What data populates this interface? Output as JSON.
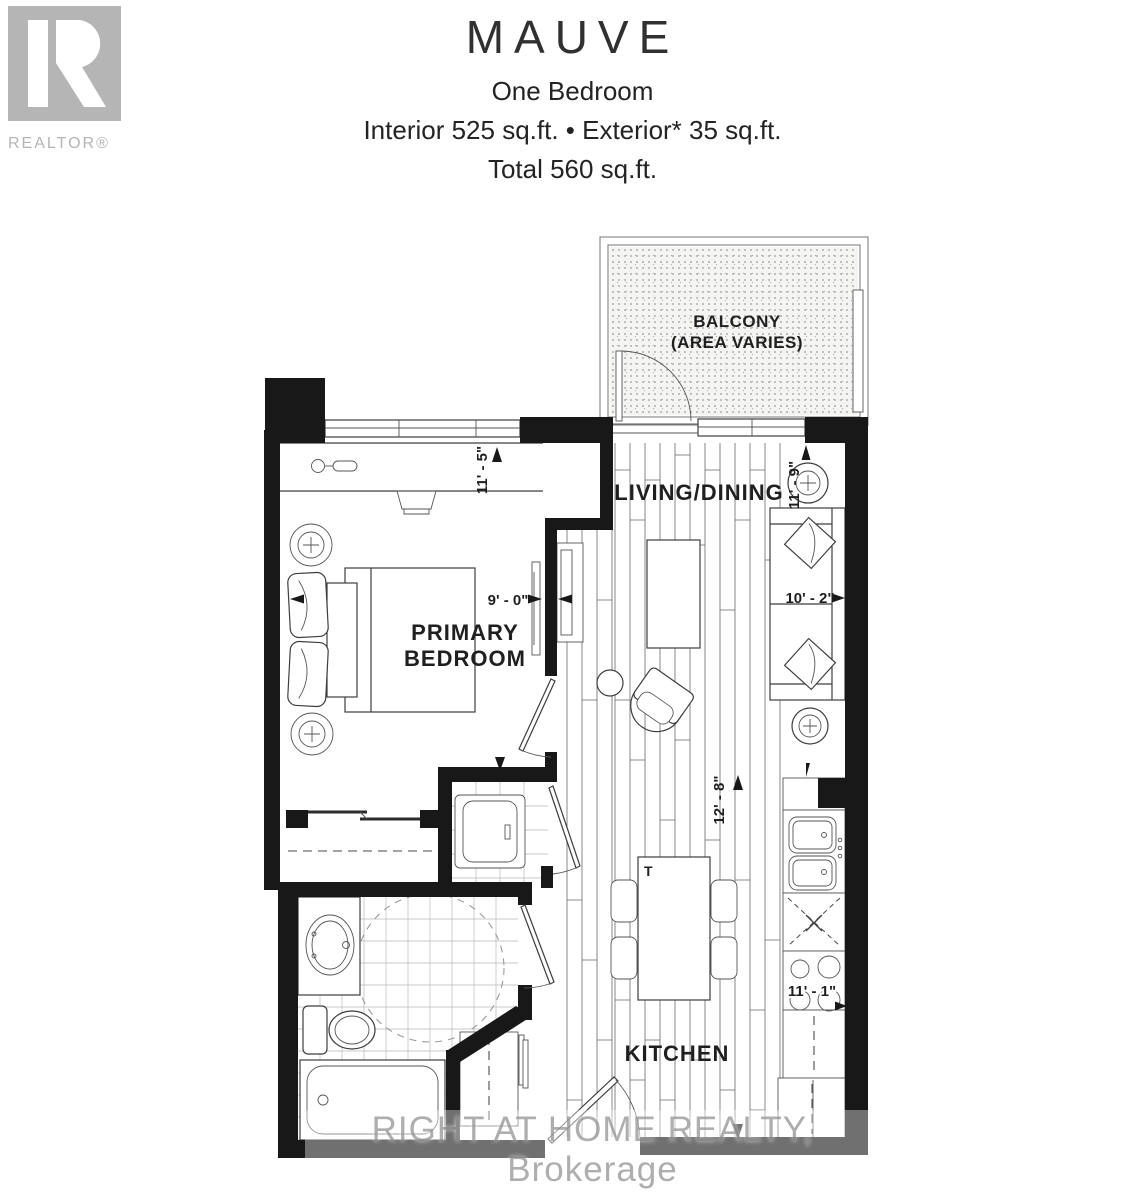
{
  "header": {
    "logo_label": "REALTOR®",
    "title": "MAUVE",
    "subtitle": "One Bedroom",
    "area_line": "Interior 525 sq.ft. • Exterior* 35 sq.ft.",
    "total_line": "Total 560 sq.ft."
  },
  "rooms": {
    "balcony": {
      "line1": "BALCONY",
      "line2": "(AREA VARIES)"
    },
    "living_dining": {
      "label": "LIVING/DINING"
    },
    "primary_bedroom": {
      "line1": "PRIMARY",
      "line2": "BEDROOM"
    },
    "kitchen": {
      "label": "KITCHEN"
    }
  },
  "dimensions": {
    "bedroom_depth": "11' - 5\"",
    "bedroom_width": "9' - 0\"",
    "living_depth": "11' - 9\"",
    "living_width": "10' - 2\"",
    "kitchen_length": "12' - 8\"",
    "kitchen_width": "11' - 1\""
  },
  "furniture": {
    "dining_table_label": "T"
  },
  "watermark": "RIGHT AT HOME REALTY, Brokerage",
  "colors": {
    "wall": "#181818",
    "logo_gray": "#b5b5b5",
    "stipple_dot": "#8f8f8f",
    "watermark_gray": "#a0a0a0"
  }
}
